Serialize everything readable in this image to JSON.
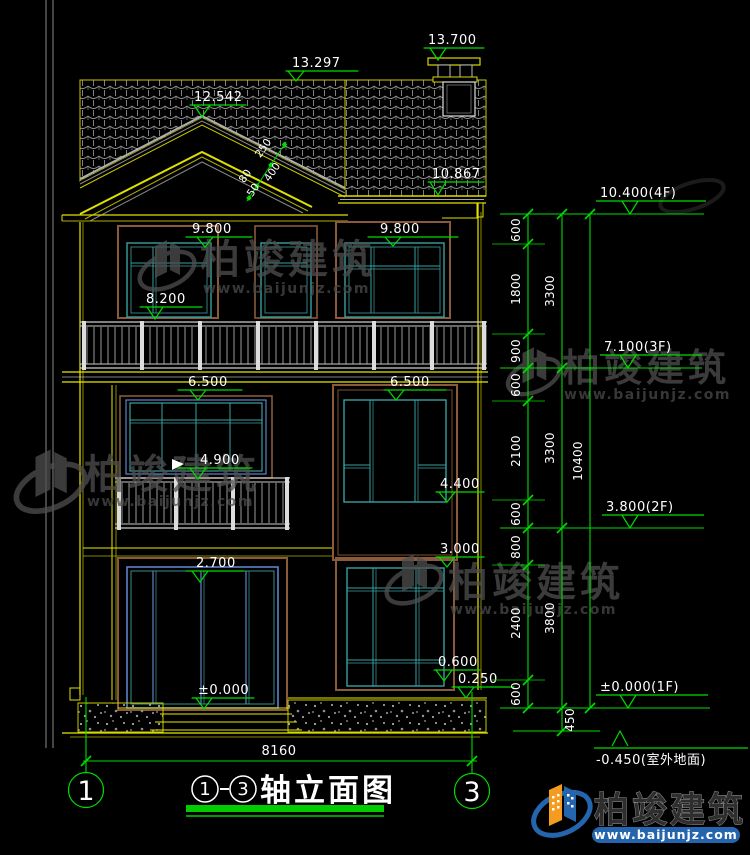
{
  "title_block": {
    "axis_start": "1",
    "dash": "-",
    "axis_end": "3",
    "name": "轴立面图"
  },
  "axis_bubbles": {
    "left": "1",
    "right": "3"
  },
  "elevation_marks": {
    "chimney_top": "13.700",
    "ridge": "13.297",
    "gable_peak": "12.542",
    "right_eave": "10.867",
    "f3_window_head_left": "9.800",
    "f3_window_head_right": "9.800",
    "f3_window_sill": "8.200",
    "f2_window_head_left": "6.500",
    "f2_window_head_right": "6.500",
    "f2_balcony_rail": "4.900",
    "f2_right_window_sill": "4.400",
    "f1_right_window_head": "3.000",
    "f1_door_head": "2.700",
    "f1_floor": "±0.000",
    "f1_right_window_sill": "0.600",
    "f1_plinth": "0.250"
  },
  "right_levels": {
    "l4f": "10.400(4F)",
    "l3f": "7.100(3F)",
    "l2f": "3.800(2F)",
    "l1f": "±0.000(1F)",
    "ground": "-0.450(室外地面)"
  },
  "chain_dims": [
    "600",
    "1800",
    "900",
    "600",
    "2100",
    "600",
    "800",
    "2400",
    "600"
  ],
  "group_totals": [
    "3300",
    "3300",
    "3800"
  ],
  "overall_height": "10400",
  "ground_drop": "450",
  "overall_width": "8160",
  "slope_dims": [
    "250",
    "400",
    "80",
    "50"
  ],
  "watermark": {
    "brand": "柏竣建筑",
    "url": "www.baijunjz.com"
  },
  "footer": {
    "brand": "柏竣建筑",
    "url": "www.baijunjz.com"
  },
  "colors": {
    "dimension_green": "#00dc00",
    "wall_yellow": "#e8e800",
    "window_teal": "#3aa0a0",
    "frame_brown": "#8a5a3a",
    "door_blue": "#5f82c8",
    "text_white": "#ffffff",
    "brand_blue": "#2565ae",
    "brand_orange": "#f59b20"
  }
}
